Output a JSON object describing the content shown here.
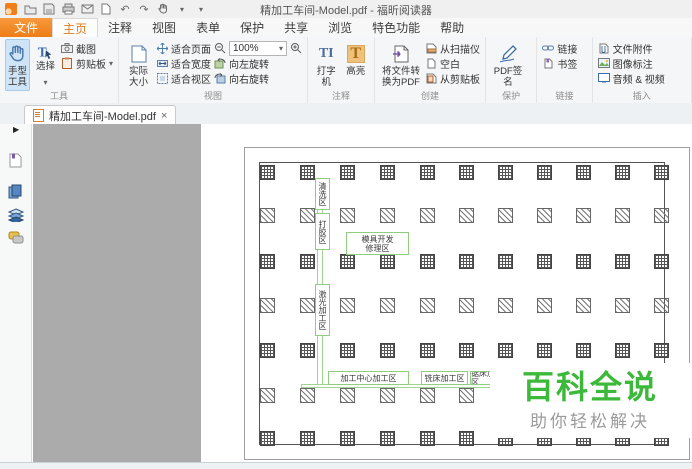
{
  "window": {
    "title": "精加工车间-Model.pdf - 福昕阅读器"
  },
  "quick_access": {
    "icons": [
      "foxit-logo",
      "open",
      "save",
      "print",
      "email",
      "new-page",
      "undo",
      "redo",
      "hand-mode",
      "customize"
    ]
  },
  "menu": {
    "file": "文件",
    "tabs": [
      "主页",
      "注释",
      "视图",
      "表单",
      "保护",
      "共享",
      "浏览",
      "特色功能",
      "帮助"
    ],
    "active": "主页"
  },
  "ribbon": {
    "tools": {
      "label": "工具",
      "hand": "手型工具",
      "select": "选择",
      "snapshot": "截图",
      "clipboard": "剪贴板"
    },
    "view": {
      "label": "视图",
      "actual_size": "实际大小",
      "fit_page": "适合页面",
      "fit_width": "适合宽度",
      "fit_visible": "适合视区",
      "rotate_left": "向左旋转",
      "rotate_right": "向右旋转",
      "zoom_value": "100%"
    },
    "comment": {
      "label": "注释",
      "typewriter": "打字机",
      "highlight": "高亮"
    },
    "create": {
      "label": "创建",
      "convert": "将文件转换为PDF",
      "from_scanner": "从扫描仪",
      "blank": "空白",
      "from_clipboard": "从剪贴板"
    },
    "protect": {
      "label": "保护",
      "pdf_sign": "PDF签名"
    },
    "link": {
      "label": "链接",
      "link": "链接",
      "bookmark": "书签"
    },
    "insert": {
      "label": "插入",
      "file_attach": "文件附件",
      "image_annot": "图像标注",
      "audio_video": "音频 & 视频"
    }
  },
  "tab_bar": {
    "document_tab": "精加工车间-Model.pdf"
  },
  "sidebar": {
    "panels": [
      "bookmarks",
      "pages",
      "layers",
      "comments"
    ]
  },
  "floorplan": {
    "grid": {
      "size": 15,
      "cols": [
        15,
        55,
        95,
        135,
        175,
        214,
        253,
        292,
        331,
        370,
        409
      ],
      "rows": [
        {
          "y": 17,
          "t": "c"
        },
        {
          "y": 60,
          "t": "d"
        },
        {
          "y": 106,
          "t": "c"
        },
        {
          "y": 150,
          "t": "d"
        },
        {
          "y": 195,
          "t": "c"
        },
        {
          "y": 240,
          "t": "d"
        },
        {
          "y": 283,
          "t": "c"
        }
      ]
    },
    "corridors": [
      {
        "name": "vertical-corridor",
        "x": 72,
        "y": 30,
        "w": 6,
        "h": 209
      },
      {
        "name": "horizontal-corridor",
        "x": 56,
        "y": 236,
        "w": 200,
        "h": 4
      }
    ],
    "zones": [
      {
        "name": "clean-zone",
        "text": "清洗区",
        "orient": "v",
        "x": 70,
        "y": 30,
        "w": 15,
        "h": 32
      },
      {
        "name": "glue-zone",
        "text": "打胶区",
        "orient": "v",
        "x": 70,
        "y": 65,
        "w": 15,
        "h": 37
      },
      {
        "name": "mold-repair-zone",
        "lines": [
          "模具开发",
          "修理区"
        ],
        "orient": "h",
        "x": 101,
        "y": 84,
        "w": 63,
        "h": 23
      },
      {
        "name": "laser-zone",
        "text": "激光加工区",
        "orient": "v",
        "x": 70,
        "y": 136,
        "w": 15,
        "h": 52
      },
      {
        "name": "machining-center-zone",
        "text": "加工中心加工区",
        "orient": "h",
        "x": 83,
        "y": 223,
        "w": 81,
        "h": 14
      },
      {
        "name": "milling-zone",
        "text": "铣床加工区",
        "orient": "h",
        "x": 176,
        "y": 223,
        "w": 47,
        "h": 14
      },
      {
        "name": "sawing-zone",
        "text": "锯床加工区",
        "orient": "h",
        "x": 225,
        "y": 223,
        "w": 40,
        "h": 14
      }
    ]
  },
  "watermark": {
    "title": "百科全说",
    "subtitle": "助你轻松解决",
    "title_color": "#3cb83a"
  },
  "colors": {
    "brand_orange": "#ee7d15",
    "selected_tool_bg": "#cfe4f7",
    "canvas_gray": "#ababab",
    "zone_green": "#8fce7f"
  }
}
